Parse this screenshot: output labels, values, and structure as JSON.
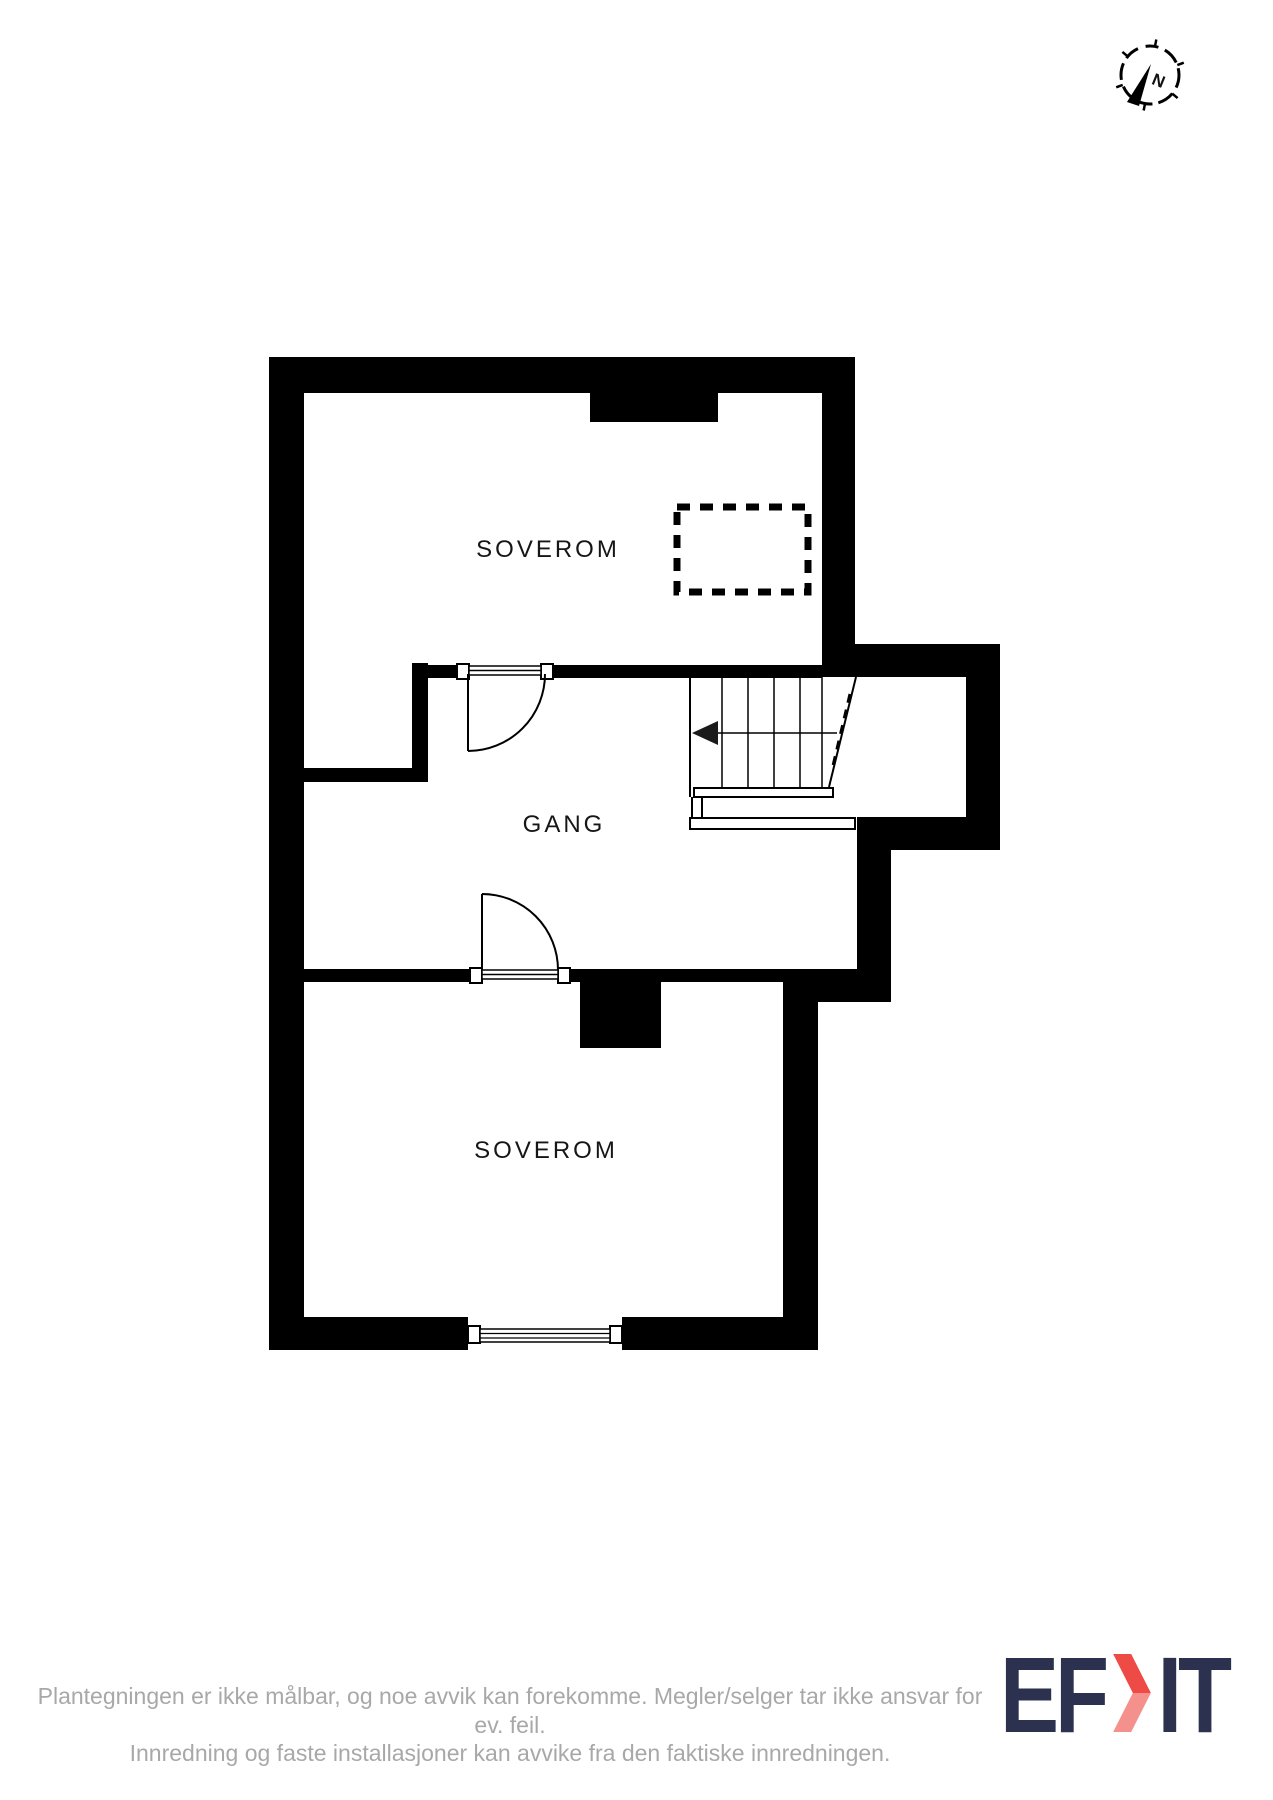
{
  "compass": {
    "north_label": "N"
  },
  "rooms": {
    "soverom_top": {
      "label": "SOVEROM"
    },
    "gang": {
      "label": "GANG"
    },
    "soverom_bottom": {
      "label": "SOVEROM"
    }
  },
  "footer": {
    "line1": "Plantegningen er ikke målbar, og noe avvik kan forekomme. Megler/selger tar ikke ansvar for ev. feil.",
    "line2": "Innredning og faste installasjoner kan avvike fra den faktiske innredningen."
  },
  "logo": {
    "left": "EF",
    "right": "IT"
  },
  "colors": {
    "wall": "#000000",
    "label_text": "#161616",
    "footer_text": "#a8a8a8",
    "logo_navy": "#2c3150",
    "logo_red": "#ee4a46",
    "logo_red_light": "#f5918c"
  }
}
